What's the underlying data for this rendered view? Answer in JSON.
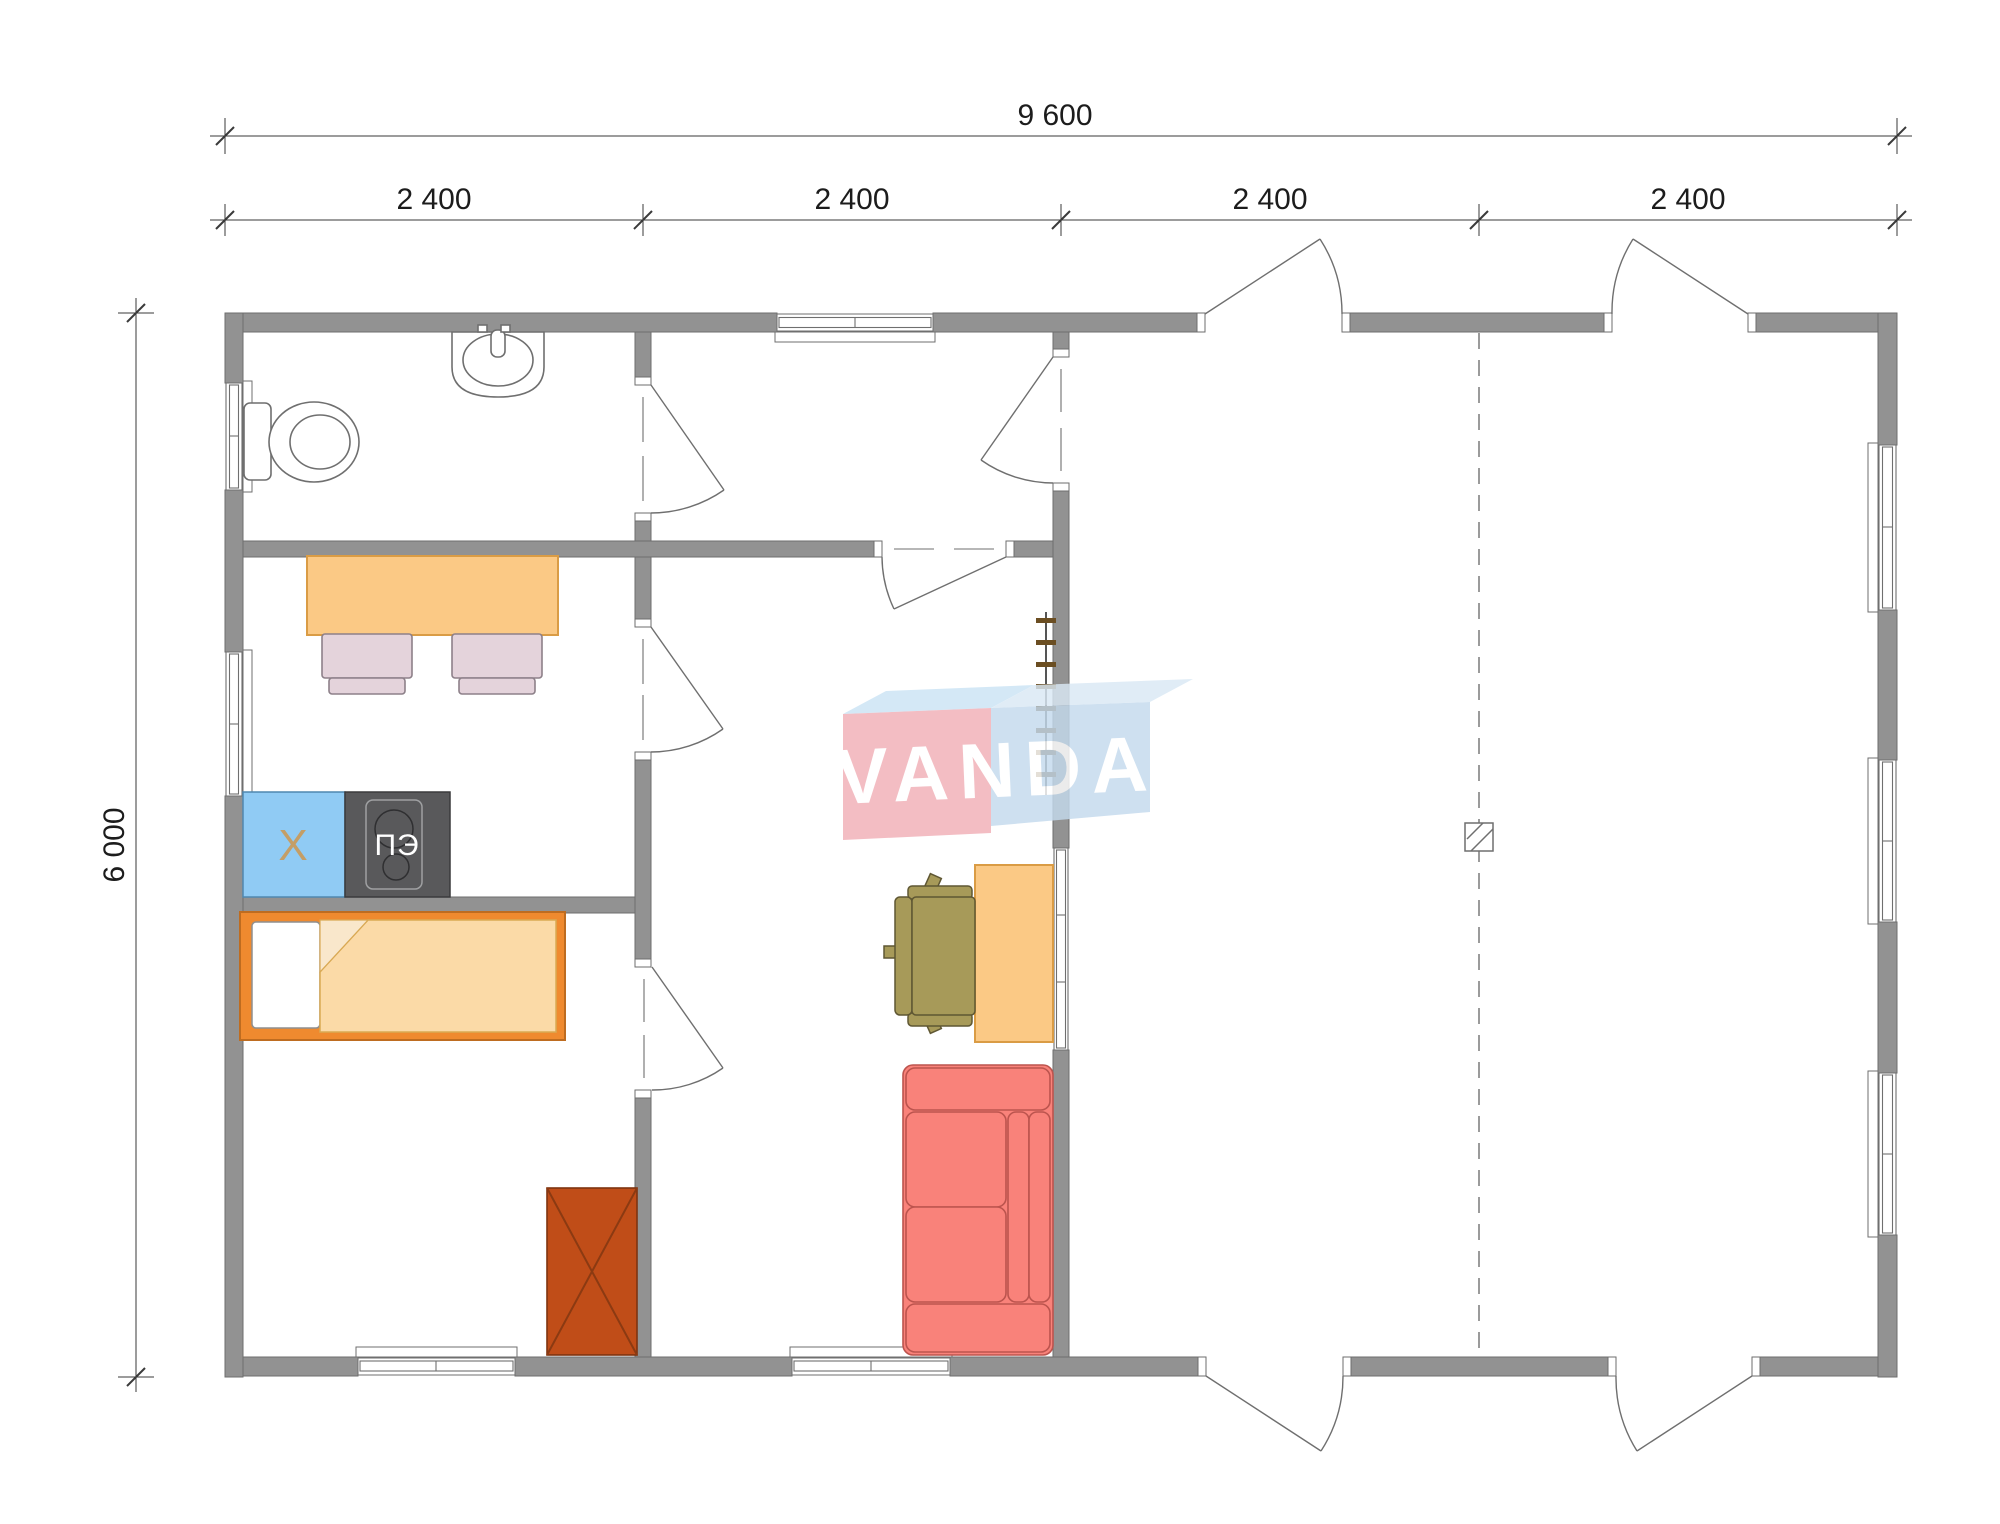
{
  "dimensions": {
    "width_total": "9 600",
    "width_segments": [
      "2 400",
      "2 400",
      "2 400",
      "2 400"
    ],
    "height_total": "6 000"
  },
  "kitchen": {
    "fridge_label": "X",
    "stove_label": "ПЭ"
  },
  "watermark": {
    "brand": "VANDA",
    "red_block_color": "#F1AFB7",
    "blue_block_color": "#C4DAED"
  },
  "colors": {
    "wall": "#929292",
    "table": "#FBC985",
    "chair": "#E4D3DB",
    "fridge": "#90CBF4",
    "stove": "#59595B",
    "bed_frame": "#EF8A2F",
    "blanket": "#FBDAA7",
    "wardrobe": "#C04D18",
    "sofa": "#F9827A",
    "office_chair": "#A79A59"
  }
}
